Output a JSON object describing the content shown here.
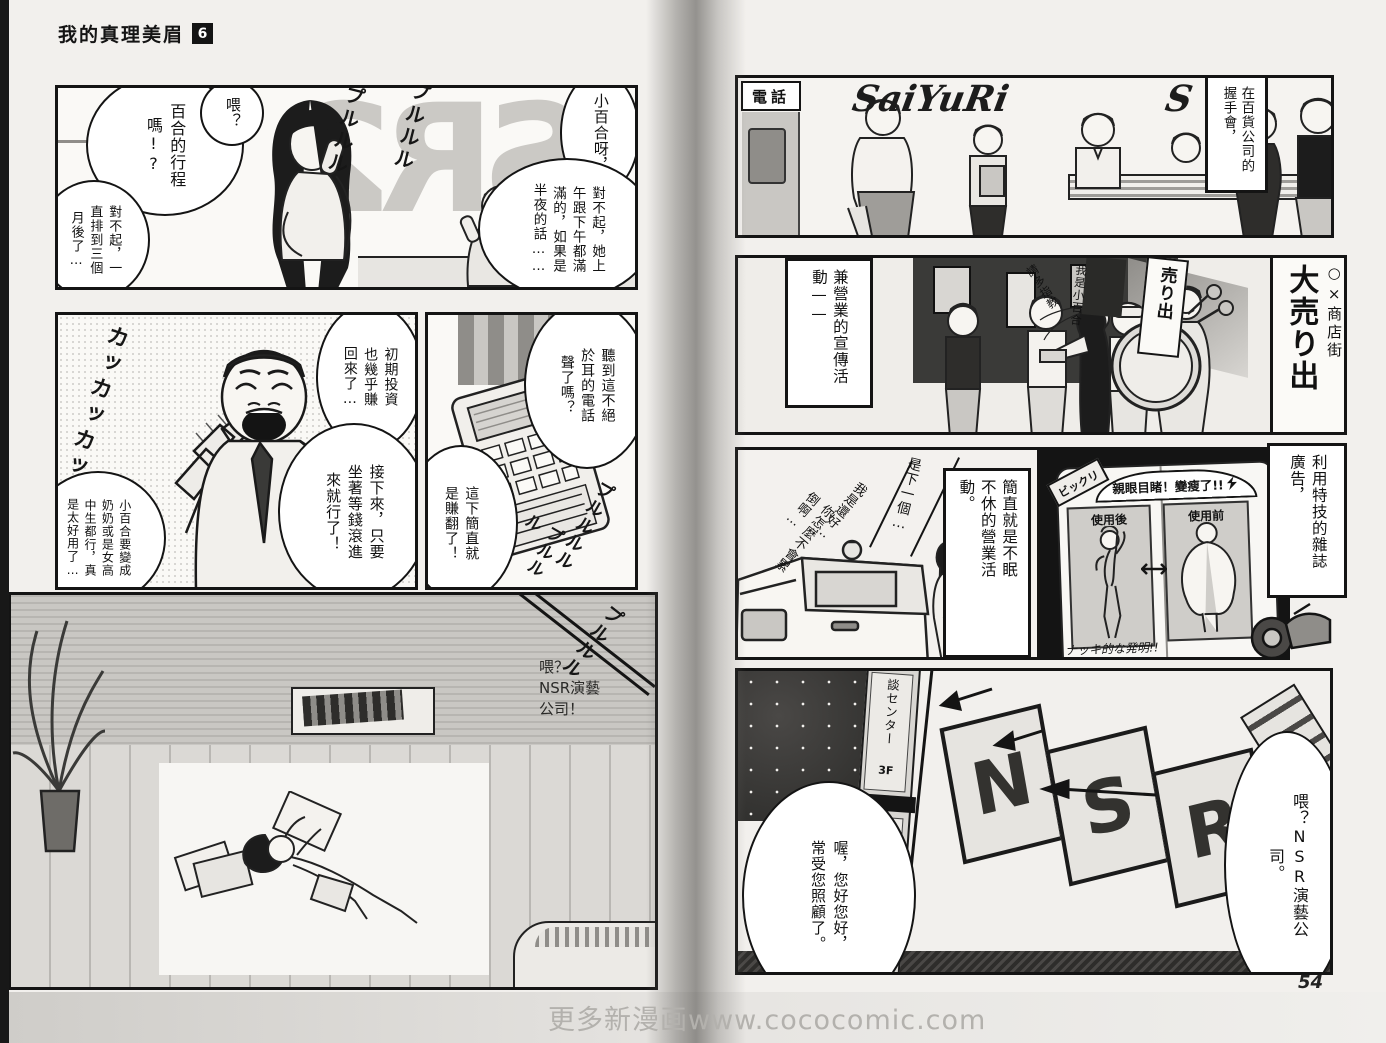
{
  "page": {
    "title": "我的真理美眉",
    "volume": "6",
    "page_number": "54",
    "watermark": "更多新漫画www.cococomic.com"
  },
  "left_page": {
    "panel1": {
      "hello": "喂？",
      "schedule_q": "百合的行程嗎!?",
      "sorry_three_months": "對不起，一直排到三個月後了…",
      "sayuri_call": "小百合呀，",
      "sorry_full": "對不起，她上午跟下午都滿滿的，如果是半夜的話……",
      "mirror_sign": "SR2",
      "sfx_ring_a": "プルルル",
      "sfx_ring_b": "プルルル"
    },
    "panel2": {
      "sfx_laugh": "カッカッカッ",
      "invest": "初期投資也幾乎賺回來了…",
      "sit_wait": "接下來，只要坐著等錢滾進來就行了！",
      "useful": "小百合要變成奶奶或是女高中生都行，真是太好用了…"
    },
    "panel3": {
      "hear_phone": "聽到這不絕於耳的電話聲了嗎？",
      "jackpot": "這下簡直就是賺翻了！",
      "sfx_ring_a": "プルルルル",
      "sfx_ring_b": "プルルル"
    },
    "panel4": {
      "sfx_ring": "プルルル",
      "hello_nsr": "喂？\nNSR演藝\n公司！"
    }
  },
  "right_page": {
    "panel1": {
      "caption": "在百貨公司的握手會，",
      "phone_sign": "電話",
      "banner": "SaiYuRi",
      "banner_partial": "S"
    },
    "panel2": {
      "caption": "兼營業的宣傳活動——",
      "district_sign": "○×商店街",
      "sale_sign": "大売り出",
      "flag": "売り出",
      "self_intro": "我是小百合",
      "greeting": "請多指教"
    },
    "panel3": {
      "next_one": "是下一個…",
      "im_fine": "我是還好…",
      "not_tired": "你怎麼不會累倒啊…",
      "caption_nonstop": "簡直就是不眠不休的營業活動。",
      "caption_magazine": "利用特技的雜誌廣告，",
      "mag_badge": "ビックリ",
      "mag_headline": "親眼目睹！變瘦了!!",
      "mag_after": "使用後",
      "mag_before": "使用前",
      "mag_note": "ナッキ的な発明!!"
    },
    "panel4": {
      "sign_center": "談センター",
      "sign_floor_top": "3F",
      "sign_company": "㈱NSR芸能プロダクション",
      "sign_floor_bottom": "2F",
      "win_n": "N",
      "win_s": "S",
      "win_r": "R",
      "greeting_bubble": "喔，您好您好，常受您照顧了。",
      "nsr_bubble": "喂？NSR演藝公司。"
    }
  }
}
